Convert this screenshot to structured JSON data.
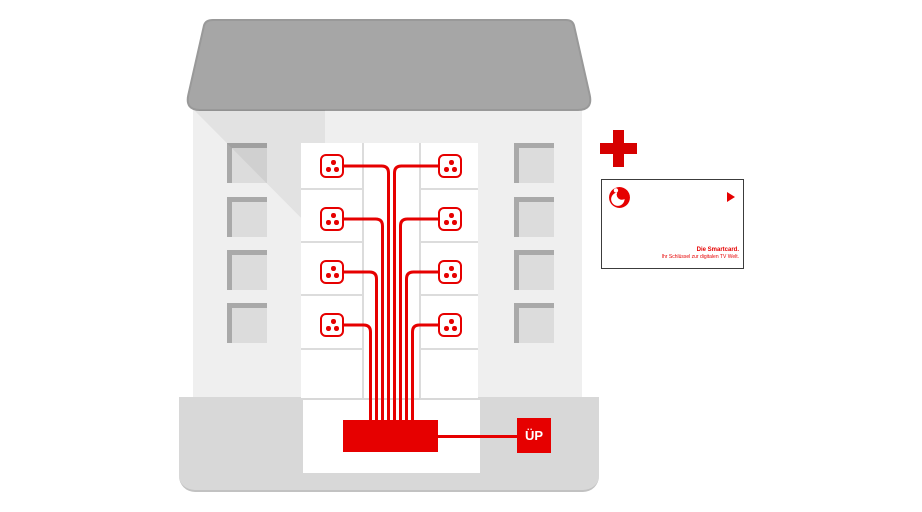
{
  "diagram": {
    "description": "Apartment building cable-TV riser diagram: 8 multimedia sockets wired to a distribution amplifier and handover point, plus Vodafone smartcard",
    "building": {
      "floors": 4,
      "sockets_total": 8,
      "windows_left": 4,
      "windows_right": 4
    }
  },
  "labels": {
    "handover_point": "ÜP"
  },
  "smartcard": {
    "title": "Die Smartcard.",
    "subtitle": "Ihr Schlüssel zur digitalen TV Welt."
  },
  "icons": {
    "plus": "plus-icon",
    "vodafone_logo": "vodafone-logo-icon",
    "tv_socket": "tv-socket-icon",
    "play_arrow": "play-arrow-icon"
  },
  "colors": {
    "vodafone_red": "#e60000",
    "plus_red": "#d60000",
    "roof_gray": "#a6a6a6",
    "facade_gray": "#efefef",
    "window_frame_gray": "#a9a9a9",
    "window_fill_gray": "#dcdcdc",
    "base_gray": "#d8d8d8",
    "card_border": "#3c3c3c"
  }
}
